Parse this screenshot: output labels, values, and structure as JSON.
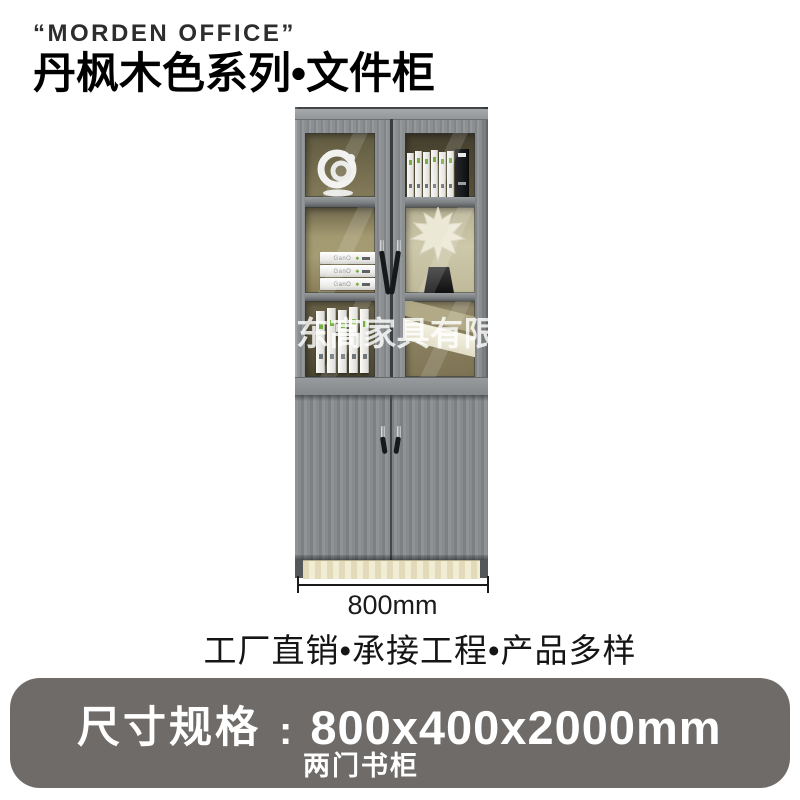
{
  "header": {
    "brand": "“MORDEN OFFICE”",
    "title": "丹枫木色系列•文件柜"
  },
  "photo": {
    "watermark": "东高家具有限",
    "dimension_label": "800mm",
    "book_spine_logo": "GanO",
    "book_logo_diamond": "◆"
  },
  "tagline": "工厂直销•承接工程•产品多样",
  "spec_banner": {
    "label": "尺寸规格",
    "colon": ":",
    "value": "800x400x2000mm",
    "subtitle": "两门书柜",
    "bg_color": "#6f6b68",
    "text_color": "#ffffff"
  },
  "colors": {
    "wood_gray": "#8c8f92",
    "interior_olive": "#857c5a",
    "plinth_cream": "#ece5c6",
    "handle_black": "#17181a",
    "accent_green": "#76b043",
    "text_dark": "#151515"
  }
}
